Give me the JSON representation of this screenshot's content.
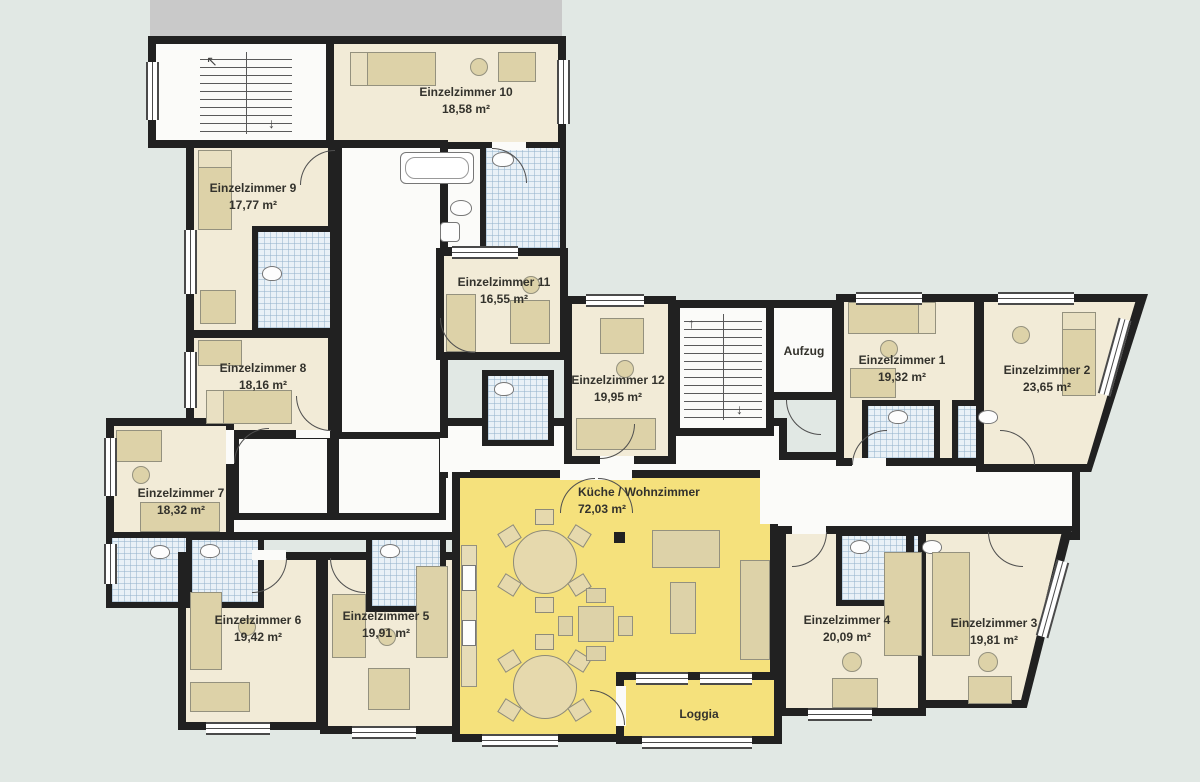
{
  "plan": {
    "background_color": "#e1e8e4",
    "wall_color": "#212121",
    "room_fill": "#f2ebd7",
    "living_fill": "#f5e17c",
    "bath_fill": "#e9f1f7",
    "furniture_fill": "#ddd2a8",
    "adjacent_building_color": "#c9c9c9"
  },
  "rooms": [
    {
      "id": "einzelzimmer-1",
      "name": "Einzelzimmer 1",
      "area": "19,32 m²"
    },
    {
      "id": "einzelzimmer-2",
      "name": "Einzelzimmer 2",
      "area": "23,65 m²"
    },
    {
      "id": "einzelzimmer-3",
      "name": "Einzelzimmer 3",
      "area": "19,81 m²"
    },
    {
      "id": "einzelzimmer-4",
      "name": "Einzelzimmer 4",
      "area": "20,09 m²"
    },
    {
      "id": "einzelzimmer-5",
      "name": "Einzelzimmer 5",
      "area": "19,91 m²"
    },
    {
      "id": "einzelzimmer-6",
      "name": "Einzelzimmer 6",
      "area": "19,42 m²"
    },
    {
      "id": "einzelzimmer-7",
      "name": "Einzelzimmer 7",
      "area": "18,32 m²"
    },
    {
      "id": "einzelzimmer-8",
      "name": "Einzelzimmer 8",
      "area": "18,16 m²"
    },
    {
      "id": "einzelzimmer-9",
      "name": "Einzelzimmer 9",
      "area": "17,77 m²"
    },
    {
      "id": "einzelzimmer-10",
      "name": "Einzelzimmer 10",
      "area": "18,58 m²"
    },
    {
      "id": "einzelzimmer-11",
      "name": "Einzelzimmer 11",
      "area": "16,55 m²"
    },
    {
      "id": "einzelzimmer-12",
      "name": "Einzelzimmer 12",
      "area": "19,95 m²"
    },
    {
      "id": "kueche-wohnzimmer",
      "name": "Küche / Wohnzimmer",
      "area": "72,03 m²"
    },
    {
      "id": "aufzug",
      "name": "Aufzug",
      "area": ""
    },
    {
      "id": "loggia",
      "name": "Loggia",
      "area": ""
    }
  ]
}
